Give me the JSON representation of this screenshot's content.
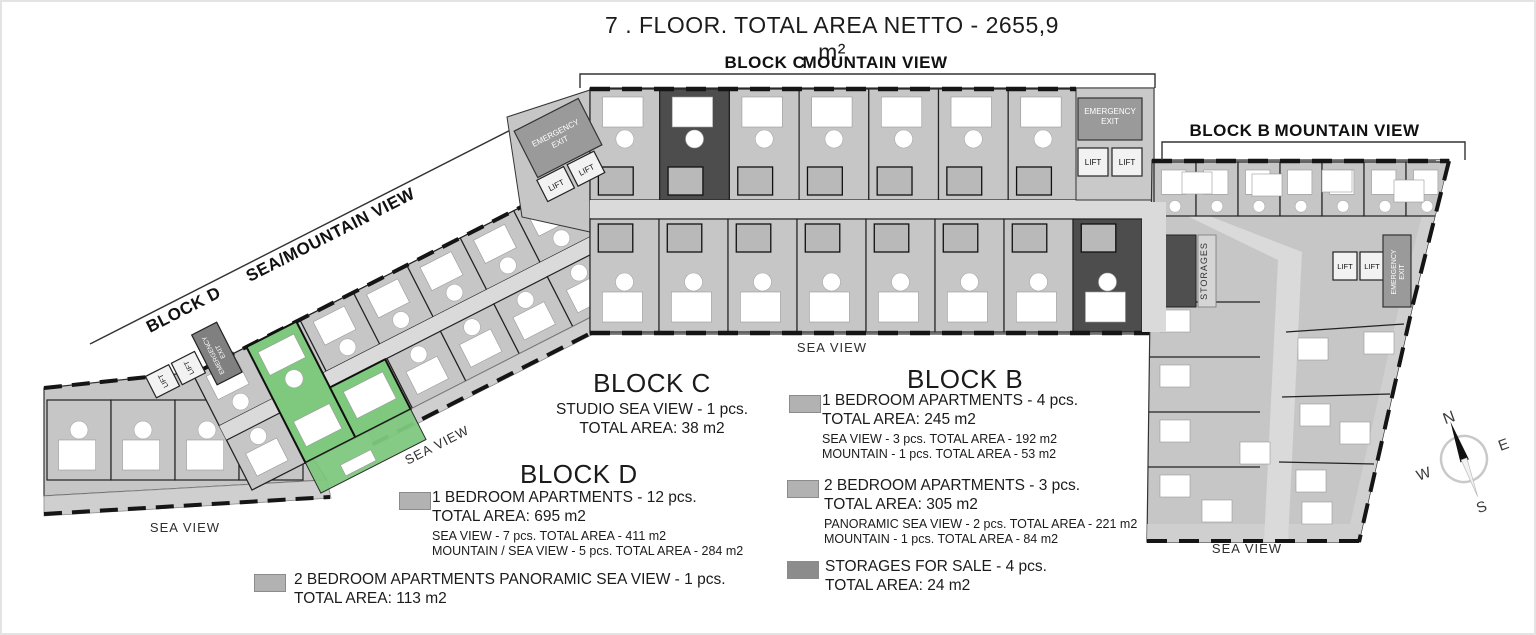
{
  "title": "7 . FLOOR. TOTAL AREA NETTO - 2655,9 m²",
  "headers": {
    "c_block": "BLOCK C",
    "c_view": "MOUNTAIN VIEW",
    "b_block": "BLOCK B",
    "b_view": "MOUNTAIN VIEW",
    "d_block": "BLOCK D",
    "d_view": "SEA/MOUNTAIN VIEW"
  },
  "plan_labels": {
    "sea_view": "SEA VIEW",
    "emergency": "EMERGENCY",
    "exit": "EXIT",
    "lift": "LIFT",
    "storages": "STORAGES"
  },
  "compass": {
    "n": "N",
    "e": "E",
    "s": "S",
    "w": "W"
  },
  "legend": {
    "block_c": {
      "title": "BLOCK C",
      "line1": "STUDIO SEA VIEW - 1 pcs.",
      "line2": "TOTAL AREA: 38 m2"
    },
    "block_d": {
      "title": "BLOCK D",
      "item1": {
        "line1": "1 BEDROOM APARTMENTS - 12 pcs.",
        "line2": "TOTAL AREA: 695 m2",
        "sub1": "SEA VIEW - 7 pcs. TOTAL AREA - 411 m2",
        "sub2": "MOUNTAIN / SEA VIEW - 5 pcs. TOTAL AREA - 284 m2"
      },
      "item2": {
        "line1": "2 BEDROOM APARTMENTS PANORAMIC SEA VIEW - 1 pcs.",
        "line2": "TOTAL AREA: 113 m2"
      }
    },
    "block_b": {
      "title": "BLOCK B",
      "item1": {
        "line1": "1 BEDROOM APARTMENTS - 4 pcs.",
        "line2": "TOTAL AREA: 245 m2",
        "sub1": "SEA VIEW - 3 pcs. TOTAL AREA - 192 m2",
        "sub2": "MOUNTAIN - 1 pcs. TOTAL AREA - 53 m2"
      },
      "item2": {
        "line1": "2 BEDROOM APARTMENTS - 3 pcs.",
        "line2": "TOTAL AREA: 305 m2",
        "sub1": "PANORAMIC SEA VIEW - 2 pcs. TOTAL AREA - 221 m2",
        "sub2": "MOUNTAIN - 1 pcs. TOTAL AREA - 84 m2"
      },
      "item3": {
        "line1": "STORAGES FOR SALE - 4 pcs.",
        "line2": "TOTAL AREA: 24 m2"
      }
    }
  },
  "colors": {
    "apartment_swatch": "#b2b2b2",
    "storage_swatch": "#8c8c8c",
    "highlight_apartment": "#7fc97f",
    "room_fill": "#c6c6c6",
    "corridor_fill": "#dadada",
    "dark_unit": "#4d4d4d"
  }
}
